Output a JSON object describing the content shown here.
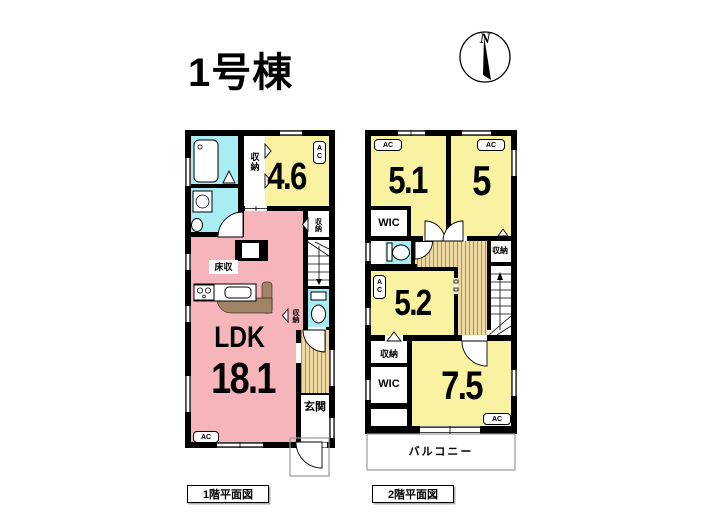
{
  "title": "1号棟",
  "compass": {
    "north_label": "N"
  },
  "labels": {
    "ac": "AC",
    "closet": "収納",
    "wic": "WIC"
  },
  "colors": {
    "room_yellow": "#f9f2a0",
    "ldk_pink": "#f6b5ba",
    "wet_area_cyan": "#a9edf4",
    "wood_floor": "#eed9a2",
    "counter_brown": "#a08465",
    "wall_black": "#000000"
  },
  "floor1": {
    "caption": "1階平面図",
    "ldk_name": "LDK",
    "ldk_size": "18.1",
    "room_size": "4.6",
    "floor_storage": "床収",
    "entrance": "玄関"
  },
  "floor2": {
    "caption": "2階平面図",
    "room1_size": "5.1",
    "room2_size": "5",
    "room3_size": "5.2",
    "room4_size": "7.5",
    "balcony": "バルコニー"
  }
}
